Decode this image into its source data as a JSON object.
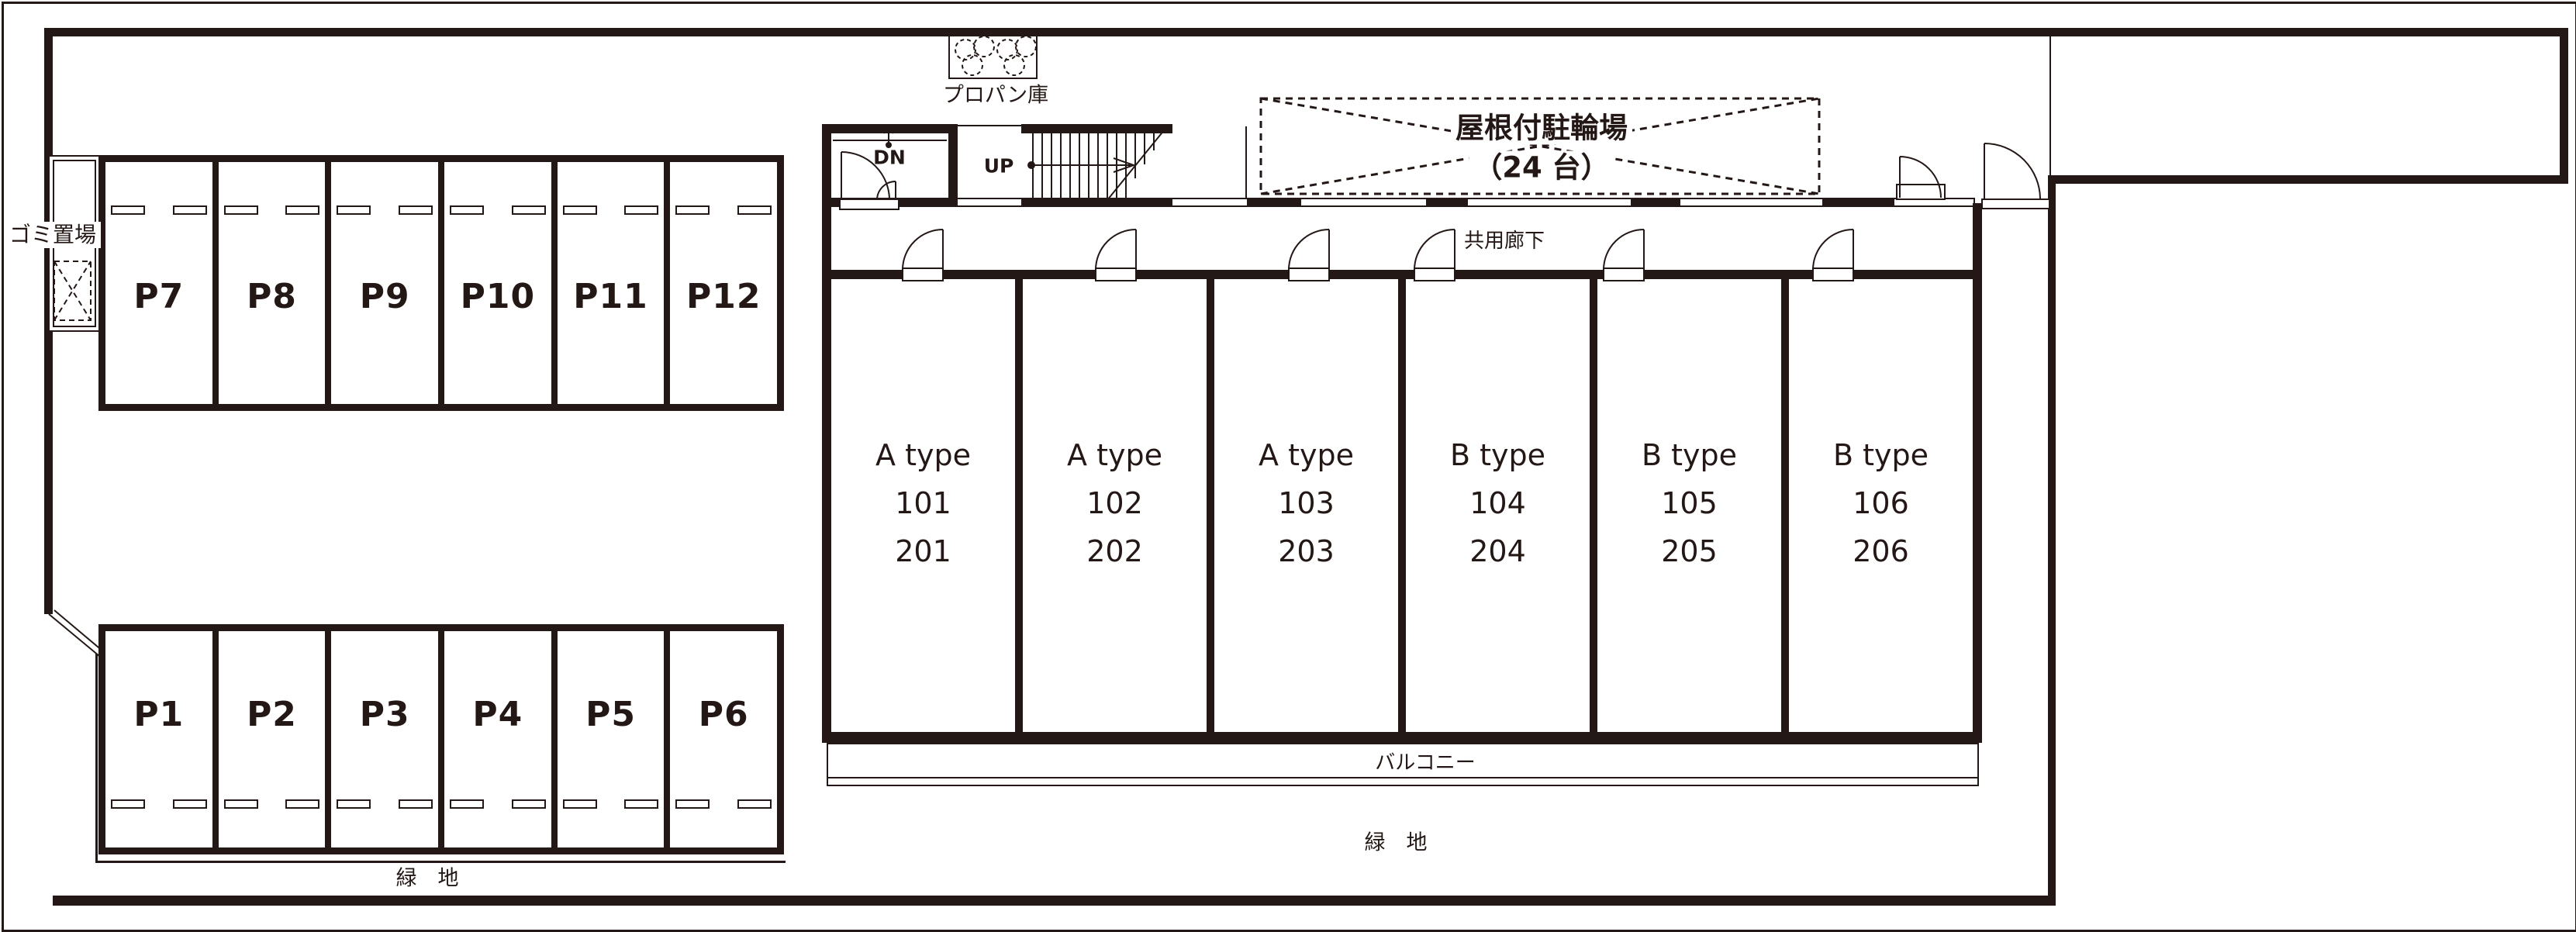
{
  "colors": {
    "ink": "#231815",
    "paper": "#ffffff"
  },
  "labels": {
    "garbage": "ゴミ置場",
    "propane": "プロパン庫",
    "bicycle_line1": "屋根付駐輪場",
    "bicycle_line2": "（24 台）",
    "corridor": "共用廊下",
    "balcony": "バルコニー",
    "green_left": "緑　地",
    "green_right": "緑　地",
    "stairs_up": "UP",
    "stairs_down": "DN"
  },
  "parking": {
    "row_top": [
      "P7",
      "P8",
      "P9",
      "P10",
      "P11",
      "P12"
    ],
    "row_bottom": [
      "P1",
      "P2",
      "P3",
      "P4",
      "P5",
      "P6"
    ]
  },
  "units": [
    {
      "type": "A type",
      "room1": "101",
      "room2": "201"
    },
    {
      "type": "A type",
      "room1": "102",
      "room2": "202"
    },
    {
      "type": "A type",
      "room1": "103",
      "room2": "203"
    },
    {
      "type": "B type",
      "room1": "104",
      "room2": "204"
    },
    {
      "type": "B type",
      "room1": "105",
      "room2": "205"
    },
    {
      "type": "B type",
      "room1": "106",
      "room2": "206"
    }
  ]
}
